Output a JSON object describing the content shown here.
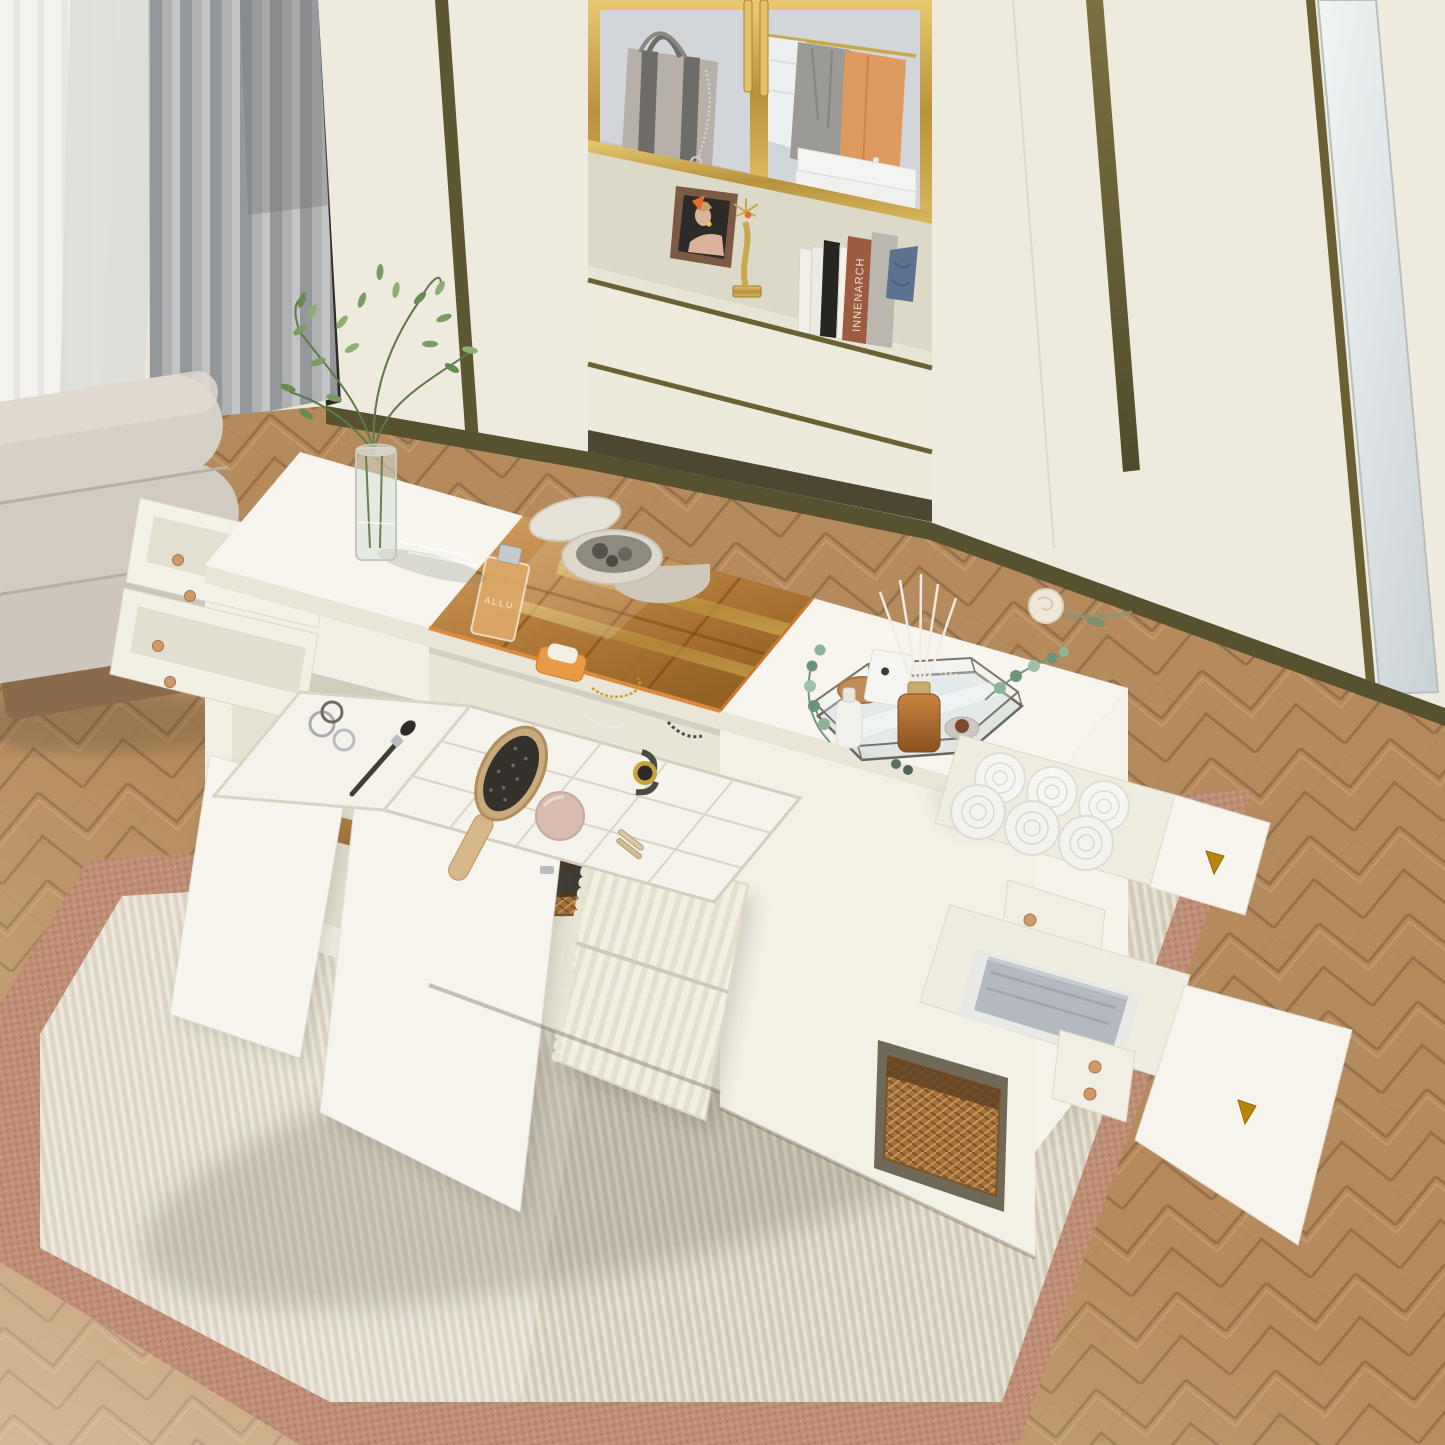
{
  "scene": {
    "description": "Top-down oblique photo of a white storage island / vanity with open drawers and amber glass jewelry top, in a bedroom closet with built-in cream wardrobe, gold-framed glass display cabinet, gray curtains, beige ottoman, herringbone wood floor and striped area rug",
    "objects": [
      "built-in wardrobe with gold-framed glass display cabinet",
      "gray striped tote bag with chain",
      "hanging white shirt, gray jacket and orange coat",
      "stack of folded white towels",
      "framed portrait photo",
      "gold candlestick sculpture",
      "books and denim fabric on open shelf",
      "two wide wardrobe drawers with olive trim",
      "white storage island with tinted amber glass top",
      "perfume bottle",
      "round stone jewelry box with lid ajar",
      "jewelry compartments with gold, pearl and bead necklaces",
      "white grid jewelry organizer with wrist watch and blush compact",
      "paddle hairbrush and makeup brush",
      "glass vase with green branches",
      "hexagonal mirror tray with reed diffuser, candle and eucalyptus",
      "cream rose",
      "rolled white towels in open drawer",
      "folded gray towels in open drawer",
      "rattan storage baskets",
      "fluted cabinet door",
      "flat open cabinet doors",
      "beige channel-tufted ottoman",
      "sheer and gray curtains",
      "herringbone wood floor",
      "striped area rug with dusty-rose border"
    ]
  },
  "texts": {
    "book_spine": "INNENARCH",
    "perfume_label": "ALLU"
  },
  "palette": {
    "wall_cream": "#ebe8db",
    "wardrobe_cream": "#efecdf",
    "trim_olive": "#5c5731",
    "brass_gold": "#c9a84c",
    "glass_amber": "#b9803f",
    "island_white": "#f5f3ea",
    "floor_wood": "#b58b5e",
    "rug_field": "#d8d1c0",
    "rug_border": "#bd8d74",
    "curtain_gray": "#9fa2a4",
    "stool_beige": "#d3ccc2",
    "coat_orange": "#df9a60",
    "denim_blue": "#5d7291"
  }
}
